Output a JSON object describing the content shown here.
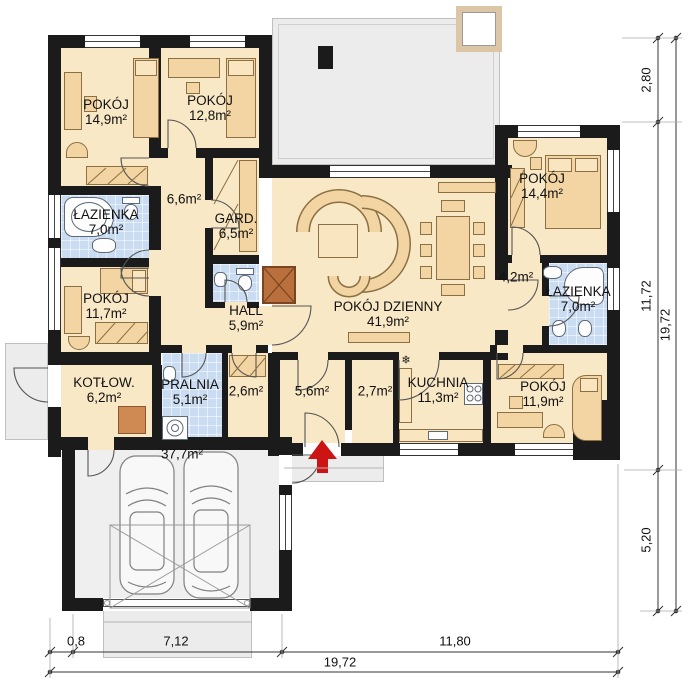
{
  "plan_title": "single-storey house floor plan",
  "rooms": [
    {
      "name": "POKÓJ",
      "area": "14,9m²"
    },
    {
      "name": "POKÓJ",
      "area": "12,8m²"
    },
    {
      "name": "ŁAZIENKA",
      "area": "7,0m²"
    },
    {
      "name": "",
      "area": "6,6m²"
    },
    {
      "name": "GARD.",
      "area": "6,5m²"
    },
    {
      "name": "POKÓJ",
      "area": "11,7m²"
    },
    {
      "name": "HALL",
      "area": "5,9m²"
    },
    {
      "name": "KOTŁOW.",
      "area": "6,2m²"
    },
    {
      "name": "PRALNIA",
      "area": "5,1m²"
    },
    {
      "name": "",
      "area": "2,6m²"
    },
    {
      "name": "POKÓJ DZIENNY",
      "area": "41,9m²"
    },
    {
      "name": "",
      "area": "5,6m²"
    },
    {
      "name": "",
      "area": "2,7m²"
    },
    {
      "name": "KUCHNIA",
      "area": "11,3m²"
    },
    {
      "name": "POKÓJ",
      "area": "11,9m²"
    },
    {
      "name": "",
      "area": "4,2m²"
    },
    {
      "name": "ŁAZIENKA",
      "area": "7,0m²"
    },
    {
      "name": "POKÓJ",
      "area": "14,4m²"
    },
    {
      "name": "",
      "area": "37,7m²"
    }
  ],
  "dimensions": {
    "bottom": [
      "0,8",
      "7,12",
      "11,80",
      "19,72"
    ],
    "right": [
      "2,80",
      "11,72",
      "5,20",
      "19,72"
    ]
  },
  "symbols": {
    "snowflake": "❄"
  },
  "colors": {
    "wall": "#1b1b1b",
    "room_floor": "#f9e8c5",
    "wet_room_floor": "#cadcf2",
    "outdoor": "#ececec",
    "furniture": "#f2d5a2",
    "fireplace": "#b9703d",
    "entry_arrow": "#cc1414"
  }
}
